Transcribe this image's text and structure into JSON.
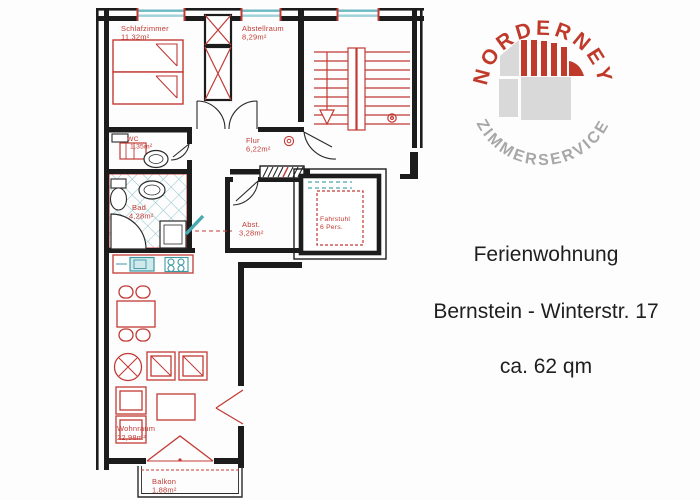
{
  "logo": {
    "arc_top": "NORDERNEY",
    "arc_bottom": "ZIMMERSERVICE",
    "colors": {
      "red": "#c03a2b",
      "gray": "#a7a7a7",
      "light_gray": "#d9d9d9"
    }
  },
  "caption": {
    "line1": "Ferienwohnung",
    "line2": "Bernstein - Winterstr. 17",
    "line3": "ca. 62 qm"
  },
  "floorplan": {
    "colors": {
      "wall": "#1c1c1c",
      "drawing_red": "#c23a35",
      "window_teal": "#49a8b2",
      "tile_teal": "#8fc3cd"
    },
    "rooms": [
      {
        "name": "Schlafzimmer",
        "area": "11,32m²"
      },
      {
        "name": "Abstellraum",
        "area": "8,29m²"
      },
      {
        "name": "WC",
        "area": "1,35m²"
      },
      {
        "name": "Flur",
        "area": "6,22m²"
      },
      {
        "name": "Bad",
        "area": "4,28m²"
      },
      {
        "name": "Abst.",
        "area": "3,28m²"
      },
      {
        "name": "Fahrstuhl",
        "area": "6 Pers."
      },
      {
        "name": "Wohnraum",
        "area": "22,98m²"
      },
      {
        "name": "Balkon",
        "area": "1,88m²"
      }
    ]
  }
}
